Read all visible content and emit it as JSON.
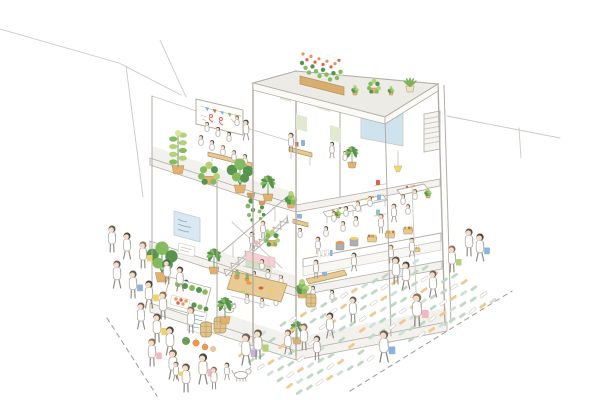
{
  "meta": {
    "description": "Hand-drawn watercolour axonometric cutaway illustration of a three-storey open-frame community building: rooftop planters, a top-floor seminar terrace with whiteboard and audience, an office room with a projection screen, a middle-floor cafe with a white staircase, sofa and hanging plants, a ground-floor greengrocer market with produce counters and a communal table, a street queue of shoppers with coloured bags, and a street plant market of crate rows with browsing customers and dashed lot lines."
  },
  "palette": {
    "paper": "#ffffff",
    "line": "#b3ada4",
    "lineSoft": "#cdc8c0",
    "slabBand": "#f3f2ee",
    "roof": "#ecebe6",
    "glassBlue": "#cfe3ef",
    "posterGreen": "#e0ead0",
    "signBlue": "#d9e8f1",
    "signInk": "#84a9c4",
    "whiteboard": "#fefefd",
    "wood": "#d8ad6d",
    "woodLight": "#e8cb92",
    "metal": "#a7adb0",
    "leafDark": "#57954f",
    "leaf": "#85bb5e",
    "leafLight": "#b3d179",
    "leafPale": "#d7e59c",
    "flowerRed": "#e2604a",
    "flowerOrange": "#ee9156",
    "pot": "#e2b16e",
    "potCream": "#eee2c2",
    "terracotta": "#d9995f",
    "skin": "#f4dcc6",
    "hair": "#5f574d",
    "hairBrown": "#8c6f52",
    "clothes": "#ffffff",
    "bagBlue": "#8bb3df",
    "bagYellow": "#f1d267",
    "bagPink": "#f4b6c1",
    "bagLav": "#c7b3da",
    "sofaPink": "#f6ced3",
    "sofaGreen": "#cfe2c3",
    "crateGreen": "#bed9c3",
    "crateTan": "#f2c88f",
    "crateTeal": "#cfe0db",
    "white": "#ffffff",
    "lamp": "#f2da5e",
    "dash": "#a59f97",
    "produceOrange": "#ee9a4c",
    "produceRed": "#dd6049",
    "produceYellow": "#f1cd60",
    "barrel": "#dfc48c",
    "barrelLine": "#b2945c",
    "potGray": "#aab0b3",
    "cactus": "#9cc47c",
    "buntingTeal": "#6fb8c9",
    "melon": "#6ca356"
  },
  "scene": {
    "rooftop": {
      "name": "rooftop-garden",
      "features": [
        "flower-box",
        "potted-succulents"
      ]
    },
    "floor3_left": {
      "name": "seminar-terrace",
      "features": [
        "whiteboard",
        "bunting",
        "audience-benches",
        "potted-plants"
      ]
    },
    "floor3_right": {
      "name": "office-room",
      "features": [
        "projection-screen",
        "green-posters",
        "desk",
        "ac-unit"
      ]
    },
    "floor2_left": {
      "name": "stair-lounge",
      "features": [
        "staircase",
        "sofa",
        "hanging-plants",
        "cacti",
        "blue-sign"
      ]
    },
    "floor2_right": {
      "name": "cafe-dining",
      "features": [
        "tables",
        "pendant-lamp",
        "wall-shelf-cups",
        "diners"
      ]
    },
    "ground_left": {
      "name": "greengrocer-stall",
      "features": [
        "vegetable-crates",
        "menu-card",
        "barrels",
        "pumpkins",
        "cat"
      ]
    },
    "ground_mid": {
      "name": "communal-table",
      "features": [
        "shared-meal",
        "benches"
      ]
    },
    "ground_right": {
      "name": "market-counter",
      "features": [
        "soup-pots",
        "produce-baskets",
        "bottle-shelf"
      ]
    },
    "street_left": {
      "name": "queue-of-shoppers",
      "features": [
        "shopping-bags",
        "children",
        "dog"
      ]
    },
    "street_right": {
      "name": "plant-market",
      "features": [
        "crate-rows",
        "browsing-customers",
        "dashed-lot-lines"
      ]
    }
  },
  "bunting_colors": [
    "buntingTeal",
    "flowerRed",
    "bagBlue",
    "leaf",
    "flowerOrange"
  ],
  "people": {
    "ppl-f3": [
      {
        "x": 201,
        "y": 148,
        "h": 16,
        "seated": 1
      },
      {
        "x": 212,
        "y": 153,
        "h": 16,
        "seated": 1
      },
      {
        "x": 223,
        "y": 158,
        "h": 16,
        "seated": 1
      },
      {
        "x": 207,
        "y": 134,
        "h": 15,
        "seated": 1
      },
      {
        "x": 218,
        "y": 139,
        "h": 15,
        "seated": 1
      },
      {
        "x": 229,
        "y": 144,
        "h": 15,
        "seated": 1
      },
      {
        "x": 237,
        "y": 128,
        "h": 15,
        "seated": 1
      },
      {
        "x": 234,
        "y": 163,
        "h": 16,
        "seated": 1
      },
      {
        "x": 245,
        "y": 167,
        "h": 16,
        "seated": 1
      },
      {
        "x": 246,
        "y": 140,
        "h": 20
      }
    ],
    "ppl-office": [
      {
        "x": 291,
        "y": 152,
        "h": 19
      },
      {
        "x": 332,
        "y": 158,
        "h": 16
      },
      {
        "x": 345,
        "y": 163,
        "h": 15,
        "seated": 1
      }
    ],
    "ppl-f2": [
      {
        "x": 262,
        "y": 272,
        "h": 16,
        "seated": 1
      },
      {
        "x": 252,
        "y": 249,
        "h": 17,
        "accent": "bagPink"
      },
      {
        "x": 263,
        "y": 238,
        "h": 17,
        "accent": "leafLight"
      },
      {
        "x": 300,
        "y": 240,
        "h": 15,
        "seated": 1
      },
      {
        "x": 318,
        "y": 254,
        "h": 17
      }
    ],
    "ppl-cafe": [
      {
        "x": 334,
        "y": 224,
        "h": 16,
        "seated": 1
      },
      {
        "x": 346,
        "y": 219,
        "h": 16,
        "seated": 1
      },
      {
        "x": 358,
        "y": 214,
        "h": 16,
        "seated": 1
      },
      {
        "x": 370,
        "y": 209,
        "h": 16,
        "seated": 1
      },
      {
        "x": 343,
        "y": 234,
        "h": 16,
        "seated": 1
      },
      {
        "x": 356,
        "y": 229,
        "h": 16,
        "seated": 1
      },
      {
        "x": 403,
        "y": 207,
        "h": 16,
        "seated": 1
      },
      {
        "x": 415,
        "y": 202,
        "h": 16,
        "seated": 1
      },
      {
        "x": 408,
        "y": 217,
        "h": 16,
        "seated": 1
      },
      {
        "x": 326,
        "y": 239,
        "h": 16,
        "seated": 1
      },
      {
        "x": 381,
        "y": 233,
        "h": 19
      },
      {
        "x": 394,
        "y": 222,
        "h": 18
      }
    ],
    "ppl-ground": [
      {
        "x": 316,
        "y": 278,
        "h": 18
      },
      {
        "x": 354,
        "y": 271,
        "h": 18
      },
      {
        "x": 391,
        "y": 263,
        "h": 18
      },
      {
        "x": 412,
        "y": 257,
        "h": 19,
        "accent": "basket"
      },
      {
        "x": 313,
        "y": 298,
        "h": 15,
        "seated": 1
      },
      {
        "x": 332,
        "y": 302,
        "h": 15,
        "seated": 1
      },
      {
        "x": 240,
        "y": 288,
        "h": 15,
        "seated": 1
      },
      {
        "x": 254,
        "y": 283,
        "h": 15,
        "seated": 1
      },
      {
        "x": 268,
        "y": 281,
        "h": 15,
        "seated": 1
      },
      {
        "x": 281,
        "y": 287,
        "h": 15,
        "seated": 1
      },
      {
        "x": 247,
        "y": 306,
        "h": 15,
        "seated": 1
      },
      {
        "x": 262,
        "y": 310,
        "h": 15,
        "seated": 1
      },
      {
        "x": 276,
        "y": 308,
        "h": 15,
        "seated": 1
      },
      {
        "x": 186,
        "y": 298,
        "h": 18
      },
      {
        "type": "cat",
        "x": 229,
        "y": 314
      }
    ],
    "ppl-street": [
      {
        "x": 112,
        "y": 252,
        "h": 26
      },
      {
        "x": 127,
        "y": 259,
        "h": 26
      },
      {
        "x": 143,
        "y": 268,
        "h": 26,
        "accent": "bagYellow"
      },
      {
        "x": 117,
        "y": 288,
        "h": 27
      },
      {
        "x": 133,
        "y": 298,
        "h": 27,
        "accent": "bagBlue"
      },
      {
        "x": 149,
        "y": 308,
        "h": 27,
        "accent": "bagYellow"
      },
      {
        "x": 163,
        "y": 319,
        "h": 27
      },
      {
        "x": 141,
        "y": 329,
        "h": 26
      },
      {
        "x": 157,
        "y": 342,
        "h": 28,
        "accent": "bagYellow"
      },
      {
        "x": 170,
        "y": 355,
        "h": 28
      },
      {
        "x": 152,
        "y": 366,
        "h": 27,
        "accent": "bagPink"
      },
      {
        "x": 173,
        "y": 379,
        "h": 29
      },
      {
        "x": 186,
        "y": 392,
        "h": 28
      },
      {
        "x": 203,
        "y": 384,
        "h": 30,
        "accent": "bagPink"
      },
      {
        "x": 214,
        "y": 389,
        "h": 22
      },
      {
        "x": 176,
        "y": 381,
        "h": 19,
        "accent": "bagYellow"
      },
      {
        "x": 167,
        "y": 284,
        "h": 24
      },
      {
        "x": 180,
        "y": 291,
        "h": 24
      },
      {
        "x": 191,
        "y": 333,
        "h": 26
      },
      {
        "x": 246,
        "y": 365,
        "h": 31,
        "accent": "bagLav"
      },
      {
        "x": 258,
        "y": 359,
        "h": 29,
        "accent": "leafLight"
      },
      {
        "x": 227,
        "y": 380,
        "h": 17
      },
      {
        "type": "dog",
        "x": 241,
        "y": 381
      },
      {
        "x": 384,
        "y": 362,
        "h": 31,
        "accent": "bagBlue"
      },
      {
        "x": 469,
        "y": 256,
        "h": 27
      },
      {
        "x": 480,
        "y": 261,
        "h": 27,
        "accent": "bagBlue"
      },
      {
        "x": 452,
        "y": 272,
        "h": 26,
        "accent": "leafLight"
      }
    ],
    "ppl-market": [
      {
        "x": 396,
        "y": 284,
        "h": 27
      },
      {
        "x": 406,
        "y": 289,
        "h": 27
      },
      {
        "x": 417,
        "y": 326,
        "h": 32,
        "accent": "bagPink"
      },
      {
        "x": 433,
        "y": 297,
        "h": 26
      },
      {
        "x": 353,
        "y": 322,
        "h": 25
      },
      {
        "x": 330,
        "y": 338,
        "h": 25
      },
      {
        "x": 304,
        "y": 350,
        "h": 26
      },
      {
        "x": 288,
        "y": 354,
        "h": 24
      },
      {
        "x": 317,
        "y": 360,
        "h": 24
      }
    ]
  },
  "plants": {
    "pl-f3": [
      {
        "x": 178,
        "y": 174,
        "s": 1.2,
        "t": "shrub"
      },
      {
        "x": 209,
        "y": 184,
        "s": 1.1,
        "t": "pothos"
      },
      {
        "x": 240,
        "y": 193,
        "s": 1.15,
        "t": "monstera"
      },
      {
        "x": 268,
        "y": 201,
        "s": 1.0,
        "t": "palm"
      },
      {
        "x": 291,
        "y": 208,
        "s": 0.85,
        "t": "bush"
      },
      {
        "x": 352,
        "y": 168,
        "s": 0.85,
        "t": "palm"
      }
    ],
    "pl-hang": [
      {
        "x": 251,
        "y": 198,
        "s": 1.0,
        "t": "vine"
      },
      {
        "x": 262,
        "y": 205,
        "s": 0.8,
        "t": "vine"
      }
    ],
    "pl-f2": [
      {
        "x": 214,
        "y": 274,
        "s": 1.0,
        "t": "palm"
      },
      {
        "x": 237,
        "y": 279,
        "s": 0.55,
        "t": "cactus"
      },
      {
        "x": 247,
        "y": 281,
        "s": 0.45,
        "t": "cactus"
      },
      {
        "x": 272,
        "y": 246,
        "s": 0.8,
        "t": "pothos"
      },
      {
        "x": 338,
        "y": 218,
        "s": 0.45,
        "t": "bush"
      },
      {
        "x": 428,
        "y": 198,
        "s": 0.5,
        "t": "bush"
      }
    ],
    "pl-ground": [
      {
        "x": 162,
        "y": 282,
        "s": 1.35,
        "t": "monstera"
      },
      {
        "x": 225,
        "y": 324,
        "s": 1.05,
        "t": "palm"
      },
      {
        "x": 302,
        "y": 298,
        "s": 0.95,
        "t": "bush"
      },
      {
        "x": 297,
        "y": 344,
        "s": 0.9,
        "t": "palm"
      }
    ],
    "pl-roof": [
      {
        "x": 355,
        "y": 95,
        "s": 0.5,
        "t": "bush"
      },
      {
        "x": 374,
        "y": 93,
        "s": 0.7,
        "t": "pothos"
      },
      {
        "x": 391,
        "y": 95,
        "s": 0.45,
        "t": "bush"
      },
      {
        "x": 410,
        "y": 92,
        "s": 0.75,
        "t": "aloe"
      }
    ]
  },
  "crate_field": {
    "origin": [
      232,
      348
    ],
    "di": [
      10.2,
      -4.8
    ],
    "dj": [
      9.6,
      6.3
    ],
    "ni": 20,
    "nj": 8,
    "skip": 0.15,
    "colors": [
      "crateGreen",
      "white",
      "crateTan",
      "crateTeal",
      "crateGreen"
    ]
  },
  "dashed_lines": [
    [
      107,
      318,
      157,
      396
    ],
    [
      350,
      391,
      512,
      291
    ]
  ]
}
